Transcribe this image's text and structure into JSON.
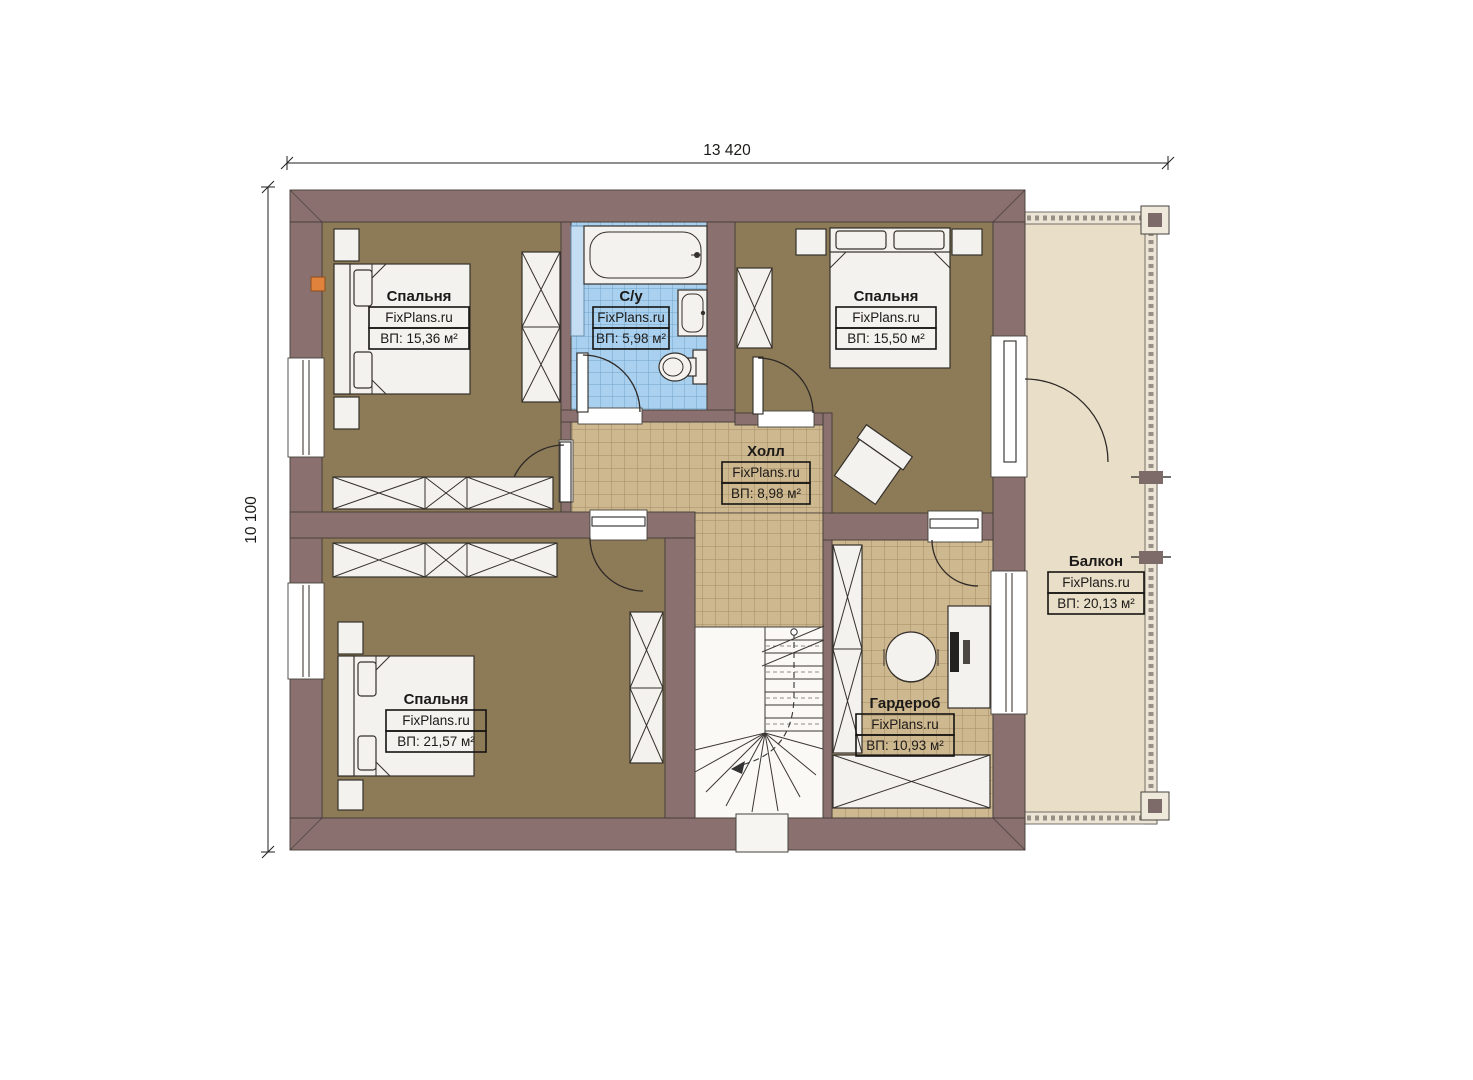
{
  "dimensions": {
    "width_label": "13 420",
    "height_label": "10 100"
  },
  "rooms": [
    {
      "id": "bedroom-top-left",
      "name": "Спальня",
      "brand": "FixPlans.ru",
      "area": "ВП: 15,36 м²"
    },
    {
      "id": "bathroom",
      "name": "С/у",
      "brand": "FixPlans.ru",
      "area": "ВП: 5,98 м²"
    },
    {
      "id": "bedroom-top-right",
      "name": "Спальня",
      "brand": "FixPlans.ru",
      "area": "ВП: 15,50 м²"
    },
    {
      "id": "hall",
      "name": "Холл",
      "brand": "FixPlans.ru",
      "area": "ВП: 8,98 м²"
    },
    {
      "id": "bedroom-bottom-left",
      "name": "Спальня",
      "brand": "FixPlans.ru",
      "area": "ВП: 21,57 м²"
    },
    {
      "id": "wardrobe",
      "name": "Гардероб",
      "brand": "FixPlans.ru",
      "area": "ВП: 10,93 м²"
    },
    {
      "id": "balcony",
      "name": "Балкон",
      "brand": "FixPlans.ru",
      "area": "ВП: 20,13 м²"
    }
  ],
  "colors": {
    "wall": "#8a7170",
    "bedroom_floor": "#8d7b58",
    "hall_tile": "#ceb890",
    "bathroom_tile": "#a9d0ee",
    "balcony_floor": "#e9dfc9",
    "marker": "#e0813c"
  }
}
